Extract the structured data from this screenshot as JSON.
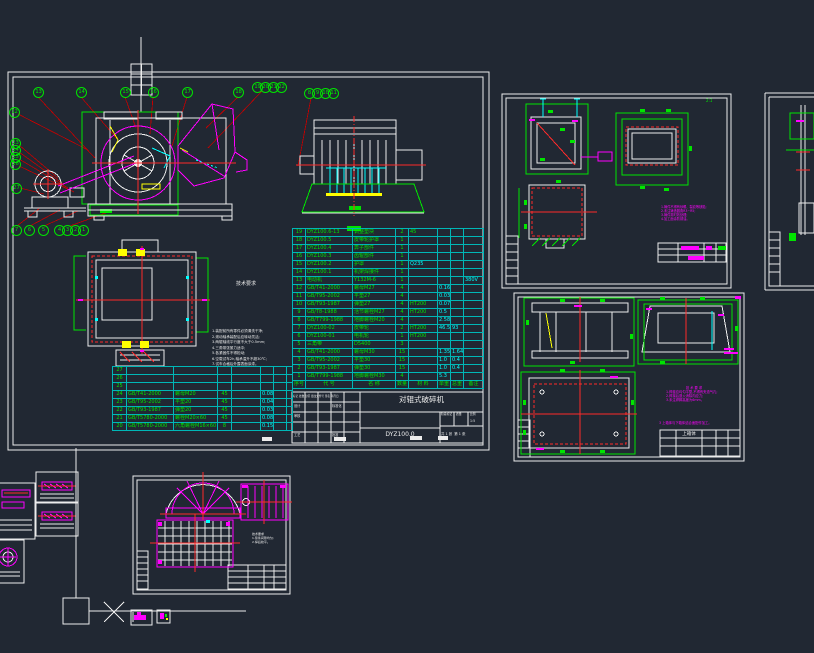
{
  "colors": {
    "background": "#212833",
    "white": "#ececec",
    "green": "#00e400",
    "magenta": "#ff00ff",
    "cyan": "#00ffff",
    "red": "#ff2a2a",
    "leader_red": "#c40000",
    "yellow": "#ffff00"
  },
  "main_sheet": {
    "notes": {
      "title": "技术要求",
      "lines": [
        "1.装配前所有零件必须清洗干净;",
        "2.滚动轴承装配后应转动灵活;",
        "3.两辊轴线平行度不大于0.5mm;",
        "4.三角带张紧力适中;",
        "5.各紧固件不得松动;",
        "6.空载试车2h,轴承温升不超30℃;",
        "7.试车合格后外露表面涂漆。"
      ]
    },
    "bom": {
      "headers": [
        "序号",
        "代  号",
        "名  称",
        "数量",
        "材 料",
        "单重",
        "总重",
        "备注"
      ],
      "rows_main": [
        [
          "19",
          "DYZ100.6-13",
          "调整垫块",
          "2",
          "45",
          "",
          "",
          ""
        ],
        [
          "18",
          "DYZ100.5",
          "皮带轮护罩",
          "1",
          "",
          "",
          "",
          ""
        ],
        [
          "17",
          "DYZ100.4",
          "箅子部件",
          "1",
          "",
          "",
          "",
          ""
        ],
        [
          "16",
          "DYZ100.3",
          "齿辊部件",
          "1",
          "",
          "",
          "",
          ""
        ],
        [
          "15",
          "DYZ100.2",
          "护罩",
          "1",
          "Q235",
          "",
          "",
          ""
        ],
        [
          "14",
          "DYZ100.1",
          "机架焊接件",
          "1",
          "",
          "",
          "",
          ""
        ],
        [
          "13",
          "电动机",
          "Y132M-6",
          "1",
          "",
          "",
          "",
          "380V"
        ],
        [
          "12",
          "GB/T41-2000",
          "螺母M27",
          "4",
          "",
          "0.16",
          "",
          ""
        ],
        [
          "11",
          "GB/T95-2002",
          "平垫27",
          "4",
          "",
          "0.03",
          "",
          ""
        ],
        [
          "10",
          "GB/T93-1987",
          "弹垫27",
          "4",
          "HT200",
          "0.07",
          "",
          ""
        ],
        [
          "9",
          "GB/T8-1988",
          "活节螺栓M27",
          "4",
          "HT200",
          "0.5",
          "",
          ""
        ],
        [
          "8",
          "GB/T799-1988",
          "地脚螺栓M20",
          "4",
          "",
          "2.58",
          "",
          ""
        ],
        [
          "7",
          "DYZ100-02",
          "皮带轮",
          "2",
          "HT200",
          "46.5",
          "93",
          ""
        ],
        [
          "6",
          "DYZ100-01",
          "电机轮",
          "1",
          "HT200",
          "",
          "",
          ""
        ],
        [
          "5",
          "三角带",
          "D5400",
          "3",
          "",
          "",
          "",
          ""
        ],
        [
          "4",
          "GB/T41-2000",
          "螺母M30",
          "15",
          "",
          "1.35",
          "1.64",
          ""
        ],
        [
          "3",
          "GB/T95-2002",
          "平垫30",
          "15",
          "",
          "1.0",
          "0.4",
          ""
        ],
        [
          "2",
          "GB/T93-1987",
          "弹垫30",
          "15",
          "",
          "1.0",
          "0.4",
          ""
        ],
        [
          "1",
          "GB/T799-1988",
          "地脚螺栓M30",
          "4",
          "",
          "5.3",
          "",
          ""
        ]
      ],
      "rows_ext": [
        [
          "27",
          "",
          "",
          "",
          "",
          "",
          "",
          ""
        ],
        [
          "26",
          "",
          "",
          "",
          "",
          "",
          "",
          ""
        ],
        [
          "25",
          "",
          "",
          "",
          "",
          "",
          "",
          ""
        ],
        [
          "24",
          "GB/T41-2000",
          "螺母M20",
          "45",
          "",
          "0.08",
          "",
          ""
        ],
        [
          "23",
          "GB/T95-2002",
          "平垫20",
          "45",
          "",
          "0.04",
          "",
          ""
        ],
        [
          "22",
          "GB/T93-1987",
          "弹垫20",
          "45",
          "",
          "0.03",
          "",
          ""
        ],
        [
          "21",
          "GB/T5780-2000",
          "螺栓M20×60",
          "45",
          "",
          "0.08",
          "",
          ""
        ],
        [
          "20",
          "GB/T5780-2000",
          "六角螺栓M16×60",
          "8",
          "",
          "0.15",
          "",
          ""
        ]
      ]
    },
    "title_block": {
      "title": "对辊式破碎机",
      "drawing_no": "DYZ100.0",
      "rev_header": "标记 处数 分区 更改文件号 签名 年月日",
      "row_design": "设计",
      "row_check": "审核",
      "row_process": "工艺",
      "row_std": "标准化",
      "row_approve": "批准",
      "stage": "阶段标记",
      "mass": "质量",
      "scale": "比例",
      "scale_value": "1:5",
      "sheets": "共 1 张  第 1 张"
    }
  },
  "sheet_top_right": {
    "corner_mark": "2:1",
    "notes_lines": [
      "1.铸件不得有砂眼、裂纹等缺陷;",
      "2.未注铸造圆角R3~R5;",
      "3.铸件需时效处理;",
      "4.加工面涂防锈油。"
    ]
  },
  "sheet_bottom_right": {
    "notes_title": "技 术 要 求",
    "notes_lines": [
      "1.焊缝应均匀平整,不得有夹渣气孔;",
      "2.焊接后退火消除内应力;",
      "3.未注焊脚高度为6mm。"
    ],
    "extra_note": "3 上箱体与下箱体结合面配作加工。",
    "title_block_title": "上箱体"
  },
  "sheet_bottom_mid": {
    "notes": [
      "技术要求",
      "1.筛条间隙均匀;",
      "2.焊后校平。"
    ]
  },
  "balloons": [
    {
      "n": "13",
      "x": 38,
      "y": 92
    },
    {
      "n": "14",
      "x": 81,
      "y": 92
    },
    {
      "n": "15",
      "x": 125,
      "y": 92
    },
    {
      "n": "16",
      "x": 153,
      "y": 92
    },
    {
      "n": "17",
      "x": 187,
      "y": 92
    },
    {
      "n": "18",
      "x": 238,
      "y": 92
    },
    {
      "n": "19",
      "x": 257,
      "y": 87
    },
    {
      "n": "20",
      "x": 265,
      "y": 87
    },
    {
      "n": "21",
      "x": 273,
      "y": 87
    },
    {
      "n": "22",
      "x": 281,
      "y": 87
    },
    {
      "n": "8",
      "x": 309,
      "y": 93
    },
    {
      "n": "9",
      "x": 317,
      "y": 93
    },
    {
      "n": "10",
      "x": 325,
      "y": 93
    },
    {
      "n": "11",
      "x": 333,
      "y": 93
    },
    {
      "n": "12",
      "x": 14,
      "y": 112
    },
    {
      "n": "23",
      "x": 15,
      "y": 143
    },
    {
      "n": "24",
      "x": 15,
      "y": 150
    },
    {
      "n": "25",
      "x": 15,
      "y": 157
    },
    {
      "n": "26",
      "x": 15,
      "y": 164
    },
    {
      "n": "27",
      "x": 16,
      "y": 188
    },
    {
      "n": "7",
      "x": 16,
      "y": 230
    },
    {
      "n": "6",
      "x": 29,
      "y": 230
    },
    {
      "n": "5",
      "x": 43,
      "y": 230
    },
    {
      "n": "4",
      "x": 59,
      "y": 230
    },
    {
      "n": "3",
      "x": 67,
      "y": 230
    },
    {
      "n": "2",
      "x": 75,
      "y": 230
    },
    {
      "n": "1",
      "x": 83,
      "y": 230
    }
  ]
}
